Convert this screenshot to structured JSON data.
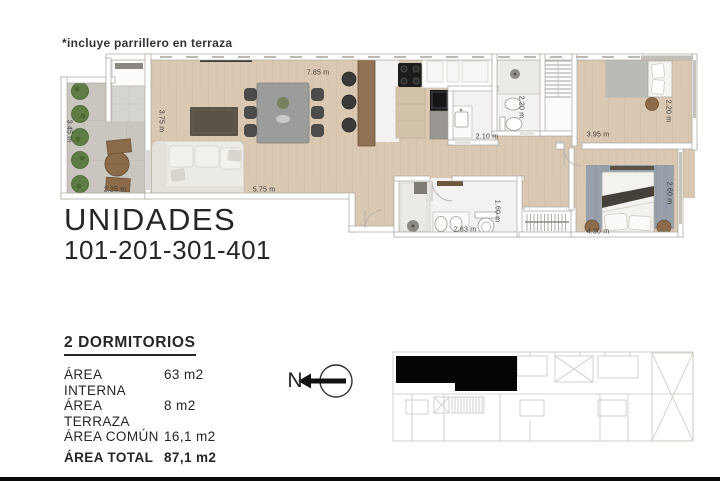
{
  "page": {
    "note": "*incluye parrillero en terraza",
    "title_line1": "UNIDADES",
    "title_line2": "101-201-301-401"
  },
  "summary": {
    "heading": "2 DORMITORIOS",
    "rows": [
      {
        "label": "ÁREA INTERNA",
        "value": "63 m2"
      },
      {
        "label": "ÁREA TERRAZA",
        "value": "8 m2"
      },
      {
        "label": "ÁREA COMÚN",
        "value": "16,1 m2"
      }
    ],
    "total": {
      "label": "ÁREA TOTAL",
      "value": "87,1 m2"
    }
  },
  "compass": {
    "label": "N"
  },
  "plan": {
    "dimensions": [
      {
        "id": "terrace-height",
        "text": "3.45 m"
      },
      {
        "id": "terrace-width",
        "text": "2.25 m"
      },
      {
        "id": "living-height",
        "text": "3.75 m"
      },
      {
        "id": "living-width",
        "text": "5.75 m"
      },
      {
        "id": "kitchen-width",
        "text": "7.85 m"
      },
      {
        "id": "bath-small-width",
        "text": "2.10 m"
      },
      {
        "id": "bath-shower-height",
        "text": "2.20 m"
      },
      {
        "id": "bedroom1-depth",
        "text": "2.20 m"
      },
      {
        "id": "bedroom1-width",
        "text": "3.95 m"
      },
      {
        "id": "bath-main-height",
        "text": "1.60 m"
      },
      {
        "id": "bath-main-width",
        "text": "2.83 m"
      },
      {
        "id": "bedroom2-depth",
        "text": "2.60 m"
      },
      {
        "id": "bedroom2-width",
        "text": "4.30 m"
      }
    ]
  },
  "colors": {
    "unit_highlight": "#000000",
    "wood_floor": "#d9c6b1",
    "terrace_floor": "#c8c5bf",
    "keyplan_lines": "#cbc7c1"
  }
}
